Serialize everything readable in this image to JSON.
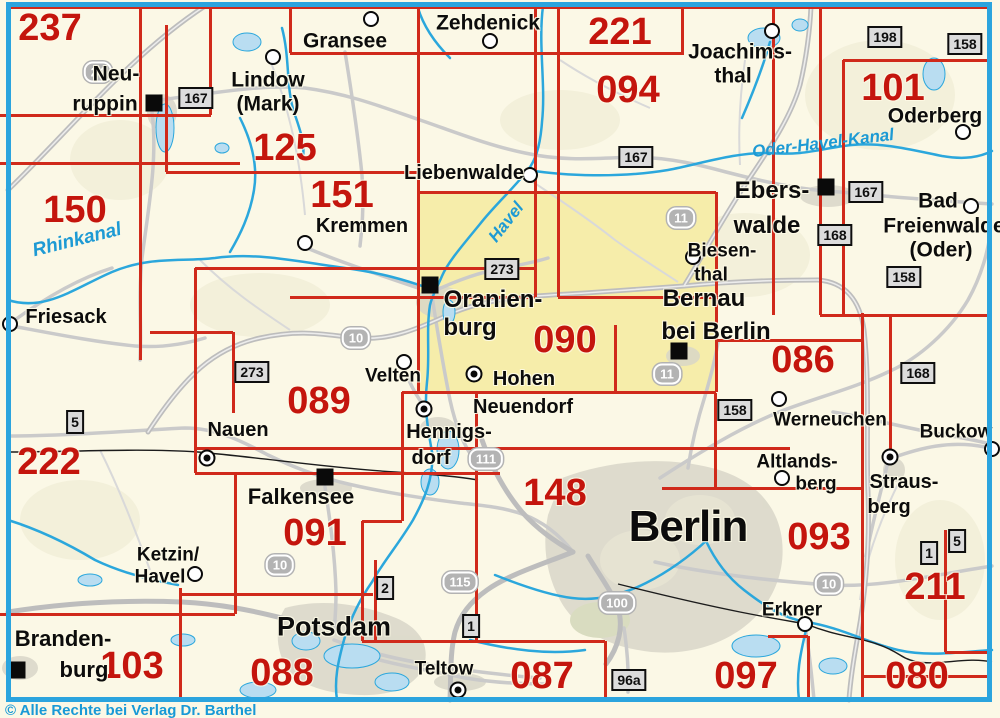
{
  "meta": {
    "copyright": "© Alle Rechte bei Verlag Dr. Barthel",
    "frame_color": "#2ba4de",
    "sheet_number_color": "#c4150d",
    "grid_color": "#d02a1b",
    "water_color": "#2ba7dc",
    "highlight_color": "#f6edaa"
  },
  "highlight": {
    "x": 420,
    "y": 193,
    "w": 296,
    "h": 198
  },
  "sheets": [
    {
      "n": "237",
      "x": 50,
      "y": 28
    },
    {
      "n": "125",
      "x": 285,
      "y": 148
    },
    {
      "n": "221",
      "x": 620,
      "y": 32
    },
    {
      "n": "094",
      "x": 628,
      "y": 90
    },
    {
      "n": "101",
      "x": 893,
      "y": 88
    },
    {
      "n": "150",
      "x": 75,
      "y": 210
    },
    {
      "n": "151",
      "x": 342,
      "y": 195
    },
    {
      "n": "222",
      "x": 49,
      "y": 462
    },
    {
      "n": "089",
      "x": 319,
      "y": 401
    },
    {
      "n": "090",
      "x": 565,
      "y": 340
    },
    {
      "n": "086",
      "x": 803,
      "y": 360
    },
    {
      "n": "091",
      "x": 315,
      "y": 533
    },
    {
      "n": "148",
      "x": 555,
      "y": 493
    },
    {
      "n": "093",
      "x": 819,
      "y": 537
    },
    {
      "n": "211",
      "x": 935,
      "y": 587
    },
    {
      "n": "103",
      "x": 132,
      "y": 666
    },
    {
      "n": "088",
      "x": 282,
      "y": 673
    },
    {
      "n": "087",
      "x": 542,
      "y": 676
    },
    {
      "n": "097",
      "x": 746,
      "y": 676
    },
    {
      "n": "080",
      "x": 917,
      "y": 676
    }
  ],
  "grid": {
    "h": [
      [
        7,
        8,
        992
      ],
      [
        53,
        290,
        682
      ],
      [
        60,
        843,
        992
      ],
      [
        115,
        0,
        211
      ],
      [
        163,
        0,
        240
      ],
      [
        172,
        166,
        418
      ],
      [
        192,
        418,
        716
      ],
      [
        268,
        195,
        535
      ],
      [
        297,
        290,
        535
      ],
      [
        297,
        558,
        716
      ],
      [
        315,
        820,
        992
      ],
      [
        332,
        150,
        233
      ],
      [
        340,
        716,
        862
      ],
      [
        392,
        402,
        716
      ],
      [
        448,
        195,
        790
      ],
      [
        473,
        195,
        500
      ],
      [
        488,
        662,
        862
      ],
      [
        521,
        362,
        402
      ],
      [
        594,
        180,
        373
      ],
      [
        614,
        0,
        235
      ],
      [
        636,
        768,
        808
      ],
      [
        641,
        362,
        605
      ],
      [
        652,
        945,
        992
      ],
      [
        676,
        862,
        992
      ]
    ],
    "v": [
      [
        140,
        7,
        360
      ],
      [
        166,
        25,
        172
      ],
      [
        180,
        588,
        698
      ],
      [
        195,
        268,
        473
      ],
      [
        210,
        7,
        115
      ],
      [
        233,
        332,
        413
      ],
      [
        235,
        473,
        614
      ],
      [
        290,
        7,
        53
      ],
      [
        362,
        521,
        641
      ],
      [
        375,
        560,
        641
      ],
      [
        402,
        392,
        521
      ],
      [
        418,
        7,
        392
      ],
      [
        476,
        392,
        641
      ],
      [
        535,
        7,
        297
      ],
      [
        558,
        7,
        297
      ],
      [
        605,
        641,
        698
      ],
      [
        615,
        325,
        392
      ],
      [
        682,
        7,
        55
      ],
      [
        715,
        393,
        488
      ],
      [
        716,
        192,
        392
      ],
      [
        773,
        7,
        315
      ],
      [
        808,
        636,
        698
      ],
      [
        820,
        7,
        315
      ],
      [
        843,
        60,
        315
      ],
      [
        862,
        313,
        698
      ],
      [
        890,
        315,
        460
      ],
      [
        945,
        530,
        652
      ]
    ]
  },
  "cities": [
    {
      "t": "Neu-",
      "x": 116,
      "y": 74,
      "s": 21
    },
    {
      "t": "ruppin",
      "x": 105,
      "y": 104,
      "s": 21
    },
    {
      "t": "Lindow",
      "x": 268,
      "y": 80,
      "s": 21
    },
    {
      "t": "(Mark)",
      "x": 268,
      "y": 104,
      "s": 21
    },
    {
      "t": "Gransee",
      "x": 345,
      "y": 41,
      "s": 21
    },
    {
      "t": "Zehdenick",
      "x": 488,
      "y": 23,
      "s": 21
    },
    {
      "t": "Joachims-",
      "x": 740,
      "y": 52,
      "s": 21
    },
    {
      "t": "thal",
      "x": 733,
      "y": 76,
      "s": 21
    },
    {
      "t": "Oderberg",
      "x": 935,
      "y": 116,
      "s": 21
    },
    {
      "t": "Bad",
      "x": 938,
      "y": 201,
      "s": 21
    },
    {
      "t": "Freienwalde",
      "x": 944,
      "y": 226,
      "s": 21
    },
    {
      "t": "(Oder)",
      "x": 941,
      "y": 250,
      "s": 21
    },
    {
      "t": "Ebers-",
      "x": 772,
      "y": 191,
      "s": 24
    },
    {
      "t": "walde",
      "x": 767,
      "y": 226,
      "s": 24
    },
    {
      "t": "Biesen-",
      "x": 722,
      "y": 251,
      "s": 19
    },
    {
      "t": "thal",
      "x": 711,
      "y": 275,
      "s": 19
    },
    {
      "t": "Bernau",
      "x": 704,
      "y": 299,
      "s": 24
    },
    {
      "t": "bei Berlin",
      "x": 716,
      "y": 332,
      "s": 24
    },
    {
      "t": "Liebenwalde",
      "x": 464,
      "y": 173,
      "s": 20
    },
    {
      "t": "Kremmen",
      "x": 362,
      "y": 226,
      "s": 20
    },
    {
      "t": "Friesack",
      "x": 66,
      "y": 317,
      "s": 20
    },
    {
      "t": "Velten",
      "x": 393,
      "y": 376,
      "s": 19
    },
    {
      "t": "Hohen",
      "x": 524,
      "y": 379,
      "s": 20
    },
    {
      "t": "Neuendorf",
      "x": 523,
      "y": 407,
      "s": 20
    },
    {
      "t": "Hennigs-",
      "x": 449,
      "y": 432,
      "s": 20
    },
    {
      "t": "dorf",
      "x": 431,
      "y": 458,
      "s": 20
    },
    {
      "t": "Nauen",
      "x": 238,
      "y": 430,
      "s": 20
    },
    {
      "t": "Werneuchen",
      "x": 830,
      "y": 420,
      "s": 19
    },
    {
      "t": "Buckow",
      "x": 956,
      "y": 432,
      "s": 19
    },
    {
      "t": "Altlands-",
      "x": 797,
      "y": 462,
      "s": 19
    },
    {
      "t": "berg",
      "x": 816,
      "y": 484,
      "s": 19
    },
    {
      "t": "Straus-",
      "x": 904,
      "y": 482,
      "s": 20
    },
    {
      "t": "berg",
      "x": 889,
      "y": 507,
      "s": 20
    },
    {
      "t": "Falkensee",
      "x": 301,
      "y": 497,
      "s": 22
    },
    {
      "t": "Berlin",
      "x": 688,
      "y": 527,
      "s": 44
    },
    {
      "t": "Ketzin/",
      "x": 168,
      "y": 555,
      "s": 19
    },
    {
      "t": "Havel",
      "x": 160,
      "y": 577,
      "s": 19
    },
    {
      "t": "Erkner",
      "x": 792,
      "y": 610,
      "s": 19
    },
    {
      "t": "Potsdam",
      "x": 334,
      "y": 627,
      "s": 27
    },
    {
      "t": "Teltow",
      "x": 444,
      "y": 669,
      "s": 19
    },
    {
      "t": "Branden-",
      "x": 63,
      "y": 639,
      "s": 22
    },
    {
      "t": "burg",
      "x": 84,
      "y": 670,
      "s": 22
    },
    {
      "t": "Oranien-",
      "x": 493,
      "y": 300,
      "s": 24
    },
    {
      "t": "burg",
      "x": 470,
      "y": 328,
      "s": 24
    }
  ],
  "water_labels": [
    {
      "t": "Rhinkanal",
      "x": 77,
      "y": 240,
      "s": 19,
      "r": -14
    },
    {
      "t": "Havel",
      "x": 506,
      "y": 222,
      "s": 17,
      "r": -52
    },
    {
      "t": "Oder-Havel-Kanal",
      "x": 823,
      "y": 143,
      "s": 17,
      "r": -7
    }
  ],
  "motorway_badges": [
    {
      "t": "24",
      "x": 98,
      "y": 72
    },
    {
      "t": "10",
      "x": 356,
      "y": 338
    },
    {
      "t": "11",
      "x": 681,
      "y": 218
    },
    {
      "t": "11",
      "x": 667,
      "y": 374
    },
    {
      "t": "111",
      "x": 486,
      "y": 459
    },
    {
      "t": "115",
      "x": 460,
      "y": 582
    },
    {
      "t": "100",
      "x": 617,
      "y": 603
    },
    {
      "t": "10",
      "x": 280,
      "y": 565
    },
    {
      "t": "10",
      "x": 829,
      "y": 584
    }
  ],
  "road_boxes": [
    {
      "t": "167",
      "x": 196,
      "y": 98
    },
    {
      "t": "167",
      "x": 636,
      "y": 157
    },
    {
      "t": "167",
      "x": 866,
      "y": 192
    },
    {
      "t": "168",
      "x": 835,
      "y": 235
    },
    {
      "t": "158",
      "x": 965,
      "y": 44
    },
    {
      "t": "198",
      "x": 885,
      "y": 37
    },
    {
      "t": "158",
      "x": 904,
      "y": 277
    },
    {
      "t": "158",
      "x": 735,
      "y": 410
    },
    {
      "t": "168",
      "x": 918,
      "y": 373
    },
    {
      "t": "273",
      "x": 502,
      "y": 269
    },
    {
      "t": "273",
      "x": 252,
      "y": 372
    },
    {
      "t": "96a",
      "x": 629,
      "y": 680
    },
    {
      "t": "2",
      "x": 385,
      "y": 588,
      "narrow": true
    },
    {
      "t": "1",
      "x": 471,
      "y": 626,
      "narrow": true
    },
    {
      "t": "1",
      "x": 929,
      "y": 553,
      "narrow": true
    },
    {
      "t": "5",
      "x": 957,
      "y": 541,
      "narrow": true
    },
    {
      "t": "5",
      "x": 75,
      "y": 422,
      "narrow": true
    }
  ],
  "markers": {
    "squares": [
      [
        154,
        103
      ],
      [
        430,
        285
      ],
      [
        826,
        187
      ],
      [
        679,
        351
      ],
      [
        325,
        477
      ],
      [
        17,
        670
      ]
    ],
    "circles": [
      [
        273,
        57
      ],
      [
        371,
        19
      ],
      [
        490,
        41
      ],
      [
        772,
        31
      ],
      [
        963,
        132
      ],
      [
        530,
        175
      ],
      [
        305,
        243
      ],
      [
        10,
        324
      ],
      [
        693,
        257
      ],
      [
        971,
        206
      ],
      [
        404,
        362
      ],
      [
        779,
        399
      ],
      [
        992,
        449
      ],
      [
        782,
        478
      ],
      [
        195,
        574
      ],
      [
        805,
        624
      ]
    ],
    "ringdots": [
      [
        474,
        374
      ],
      [
        424,
        409
      ],
      [
        207,
        458
      ],
      [
        890,
        457
      ],
      [
        458,
        690
      ]
    ]
  }
}
